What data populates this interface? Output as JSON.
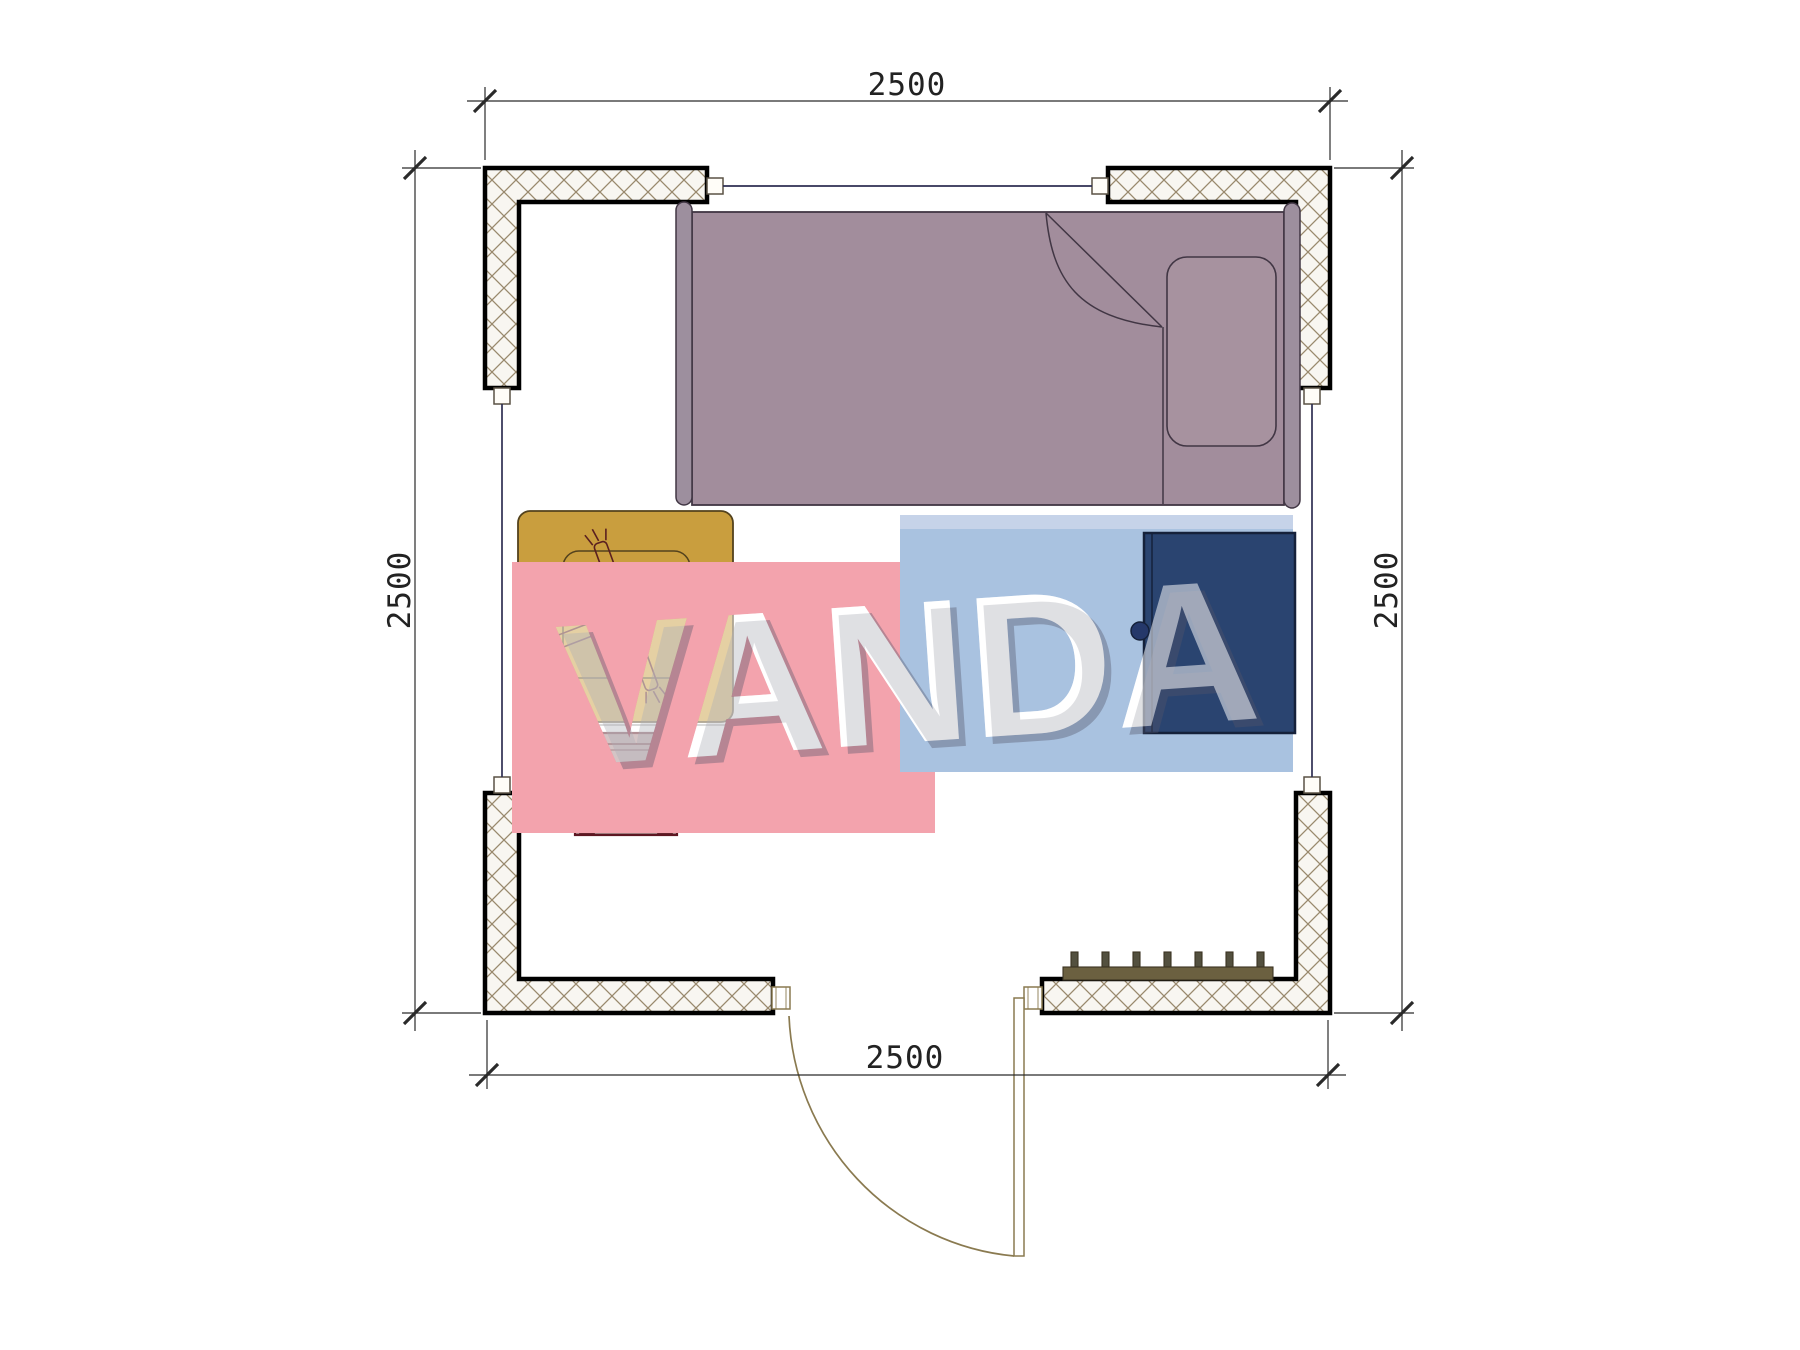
{
  "canvas": {
    "width": 1800,
    "height": 1350,
    "background": "#ffffff"
  },
  "dimensions": {
    "top": {
      "label": "2500"
    },
    "bottom": {
      "label": "2500"
    },
    "left": {
      "label": "2500"
    },
    "right": {
      "label": "2500"
    }
  },
  "watermark": {
    "text": "VANDA",
    "pink_color": "#f3a3ad",
    "blue_color": "#a9c2e0",
    "blue_top_strip_color": "#c6d3e9",
    "letter_color": "#ffffff",
    "shadow_color": "#55566a"
  },
  "structure": {
    "wall_fill": "#f8f6f1",
    "hatch_color": "#99896d",
    "wall_outline": "#000000",
    "window_line_color": "#2e2e52",
    "connector_fill": "#fffdf8",
    "dim_line_color": "#2a2a2a"
  },
  "furniture": {
    "bed": {
      "name": "single-bed",
      "fill": "#a28d9c",
      "frame_fill": "#9d8f9e",
      "pillow_fill": "#a7929f",
      "outline": "#413644"
    },
    "table": {
      "name": "bedside-table",
      "fill": "#c99e3e",
      "outline": "#53421d"
    },
    "fan": {
      "name": "table-fan-symbol",
      "stroke": "#5a2020"
    },
    "stool": {
      "name": "stool",
      "fill": "#a58587",
      "leg_fill": "#af8d8f",
      "frame": "#5d1722"
    },
    "wardrobe": {
      "name": "wardrobe",
      "fill": "#2a4470",
      "outline": "#15213a",
      "knob_fill": "#25386a"
    },
    "radiator": {
      "name": "radiator",
      "fill": "#6b6040",
      "fin_fill": "#53503f",
      "outline": "#3b3322"
    },
    "door": {
      "name": "door-swing",
      "stroke": "#8a7a50"
    }
  }
}
